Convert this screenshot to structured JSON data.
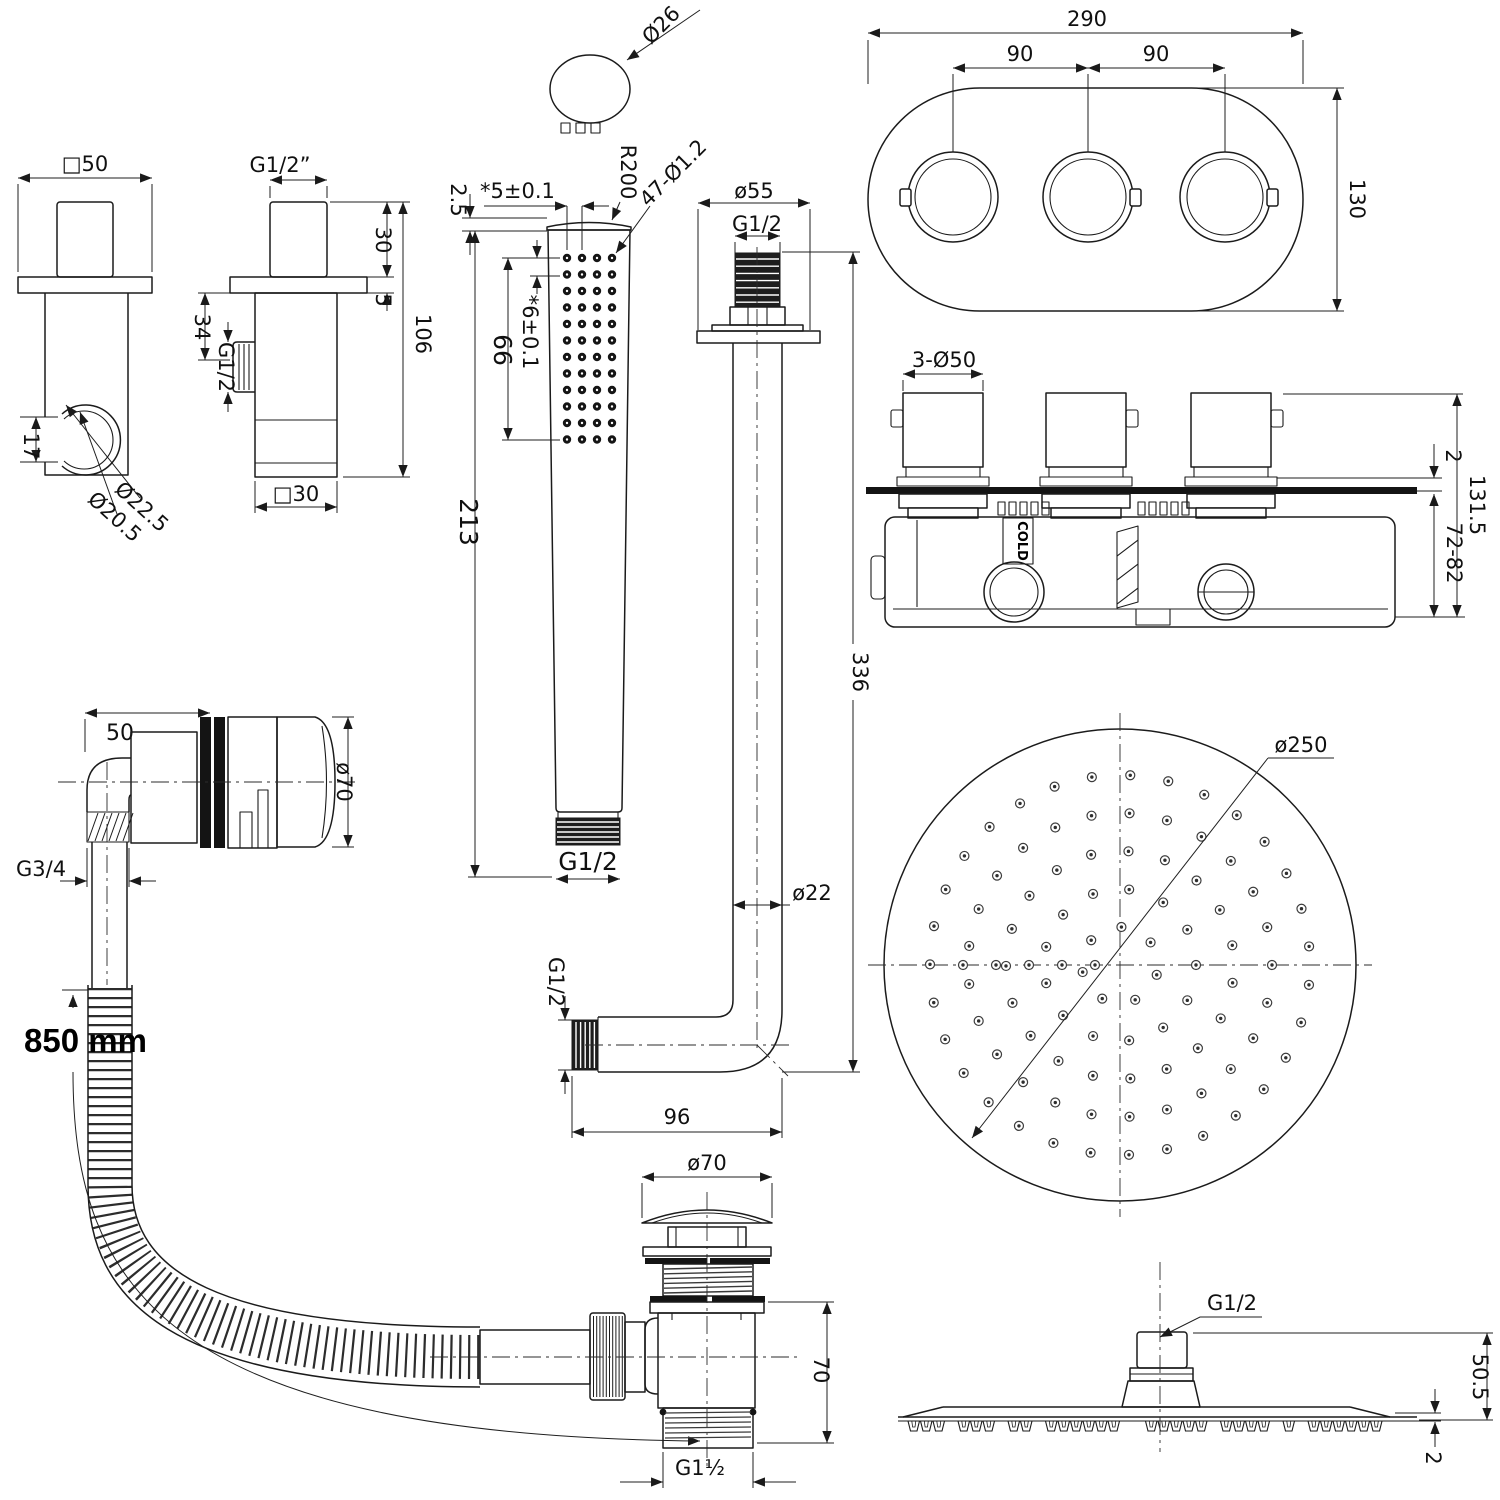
{
  "drawing": {
    "bracket_front": {
      "width": "□50",
      "slot": "17",
      "outer_dia": "Ø22.5",
      "inner_dia": "Ø20.5"
    },
    "bracket_side": {
      "thread_top": "G1/2”",
      "stub_h": "30",
      "plate_t": "5",
      "height": "106",
      "port_off": "34",
      "port_thread": "G1/2",
      "width": "□30"
    },
    "handshower": {
      "head_dia": "Ø26",
      "cap_t": "2.5",
      "col_space": "*5±0.1",
      "radius": "R200",
      "holes": "47-Ø1.2",
      "grid_h": "66",
      "row_space": "*6±0.1",
      "length": "213",
      "thread": "G1/2"
    },
    "arm": {
      "flange_dia": "ø55",
      "thread_top": "G1/2",
      "pipe_dia": "ø22",
      "length": "336",
      "thread_side": "G1/2",
      "horiz": "96"
    },
    "trim_plate": {
      "width": "290",
      "gap_left": "90",
      "gap_right": "90",
      "height": "130"
    },
    "valve": {
      "knobs": "3-Ø50",
      "plate_t": "2",
      "total_h": "131.5",
      "depth": "72-82",
      "cold": "COLD"
    },
    "rainhead": {
      "dia": "ø250"
    },
    "overflow": {
      "offset": "50",
      "cap_dia": "ø70",
      "thread": "G3/4",
      "hose_len": "850 mm"
    },
    "waste": {
      "cap_dia": "ø70",
      "height": "70",
      "outlet": "G1½"
    },
    "head_side": {
      "thread": "G1/2",
      "height": "50.5",
      "plate_t": "2"
    }
  }
}
